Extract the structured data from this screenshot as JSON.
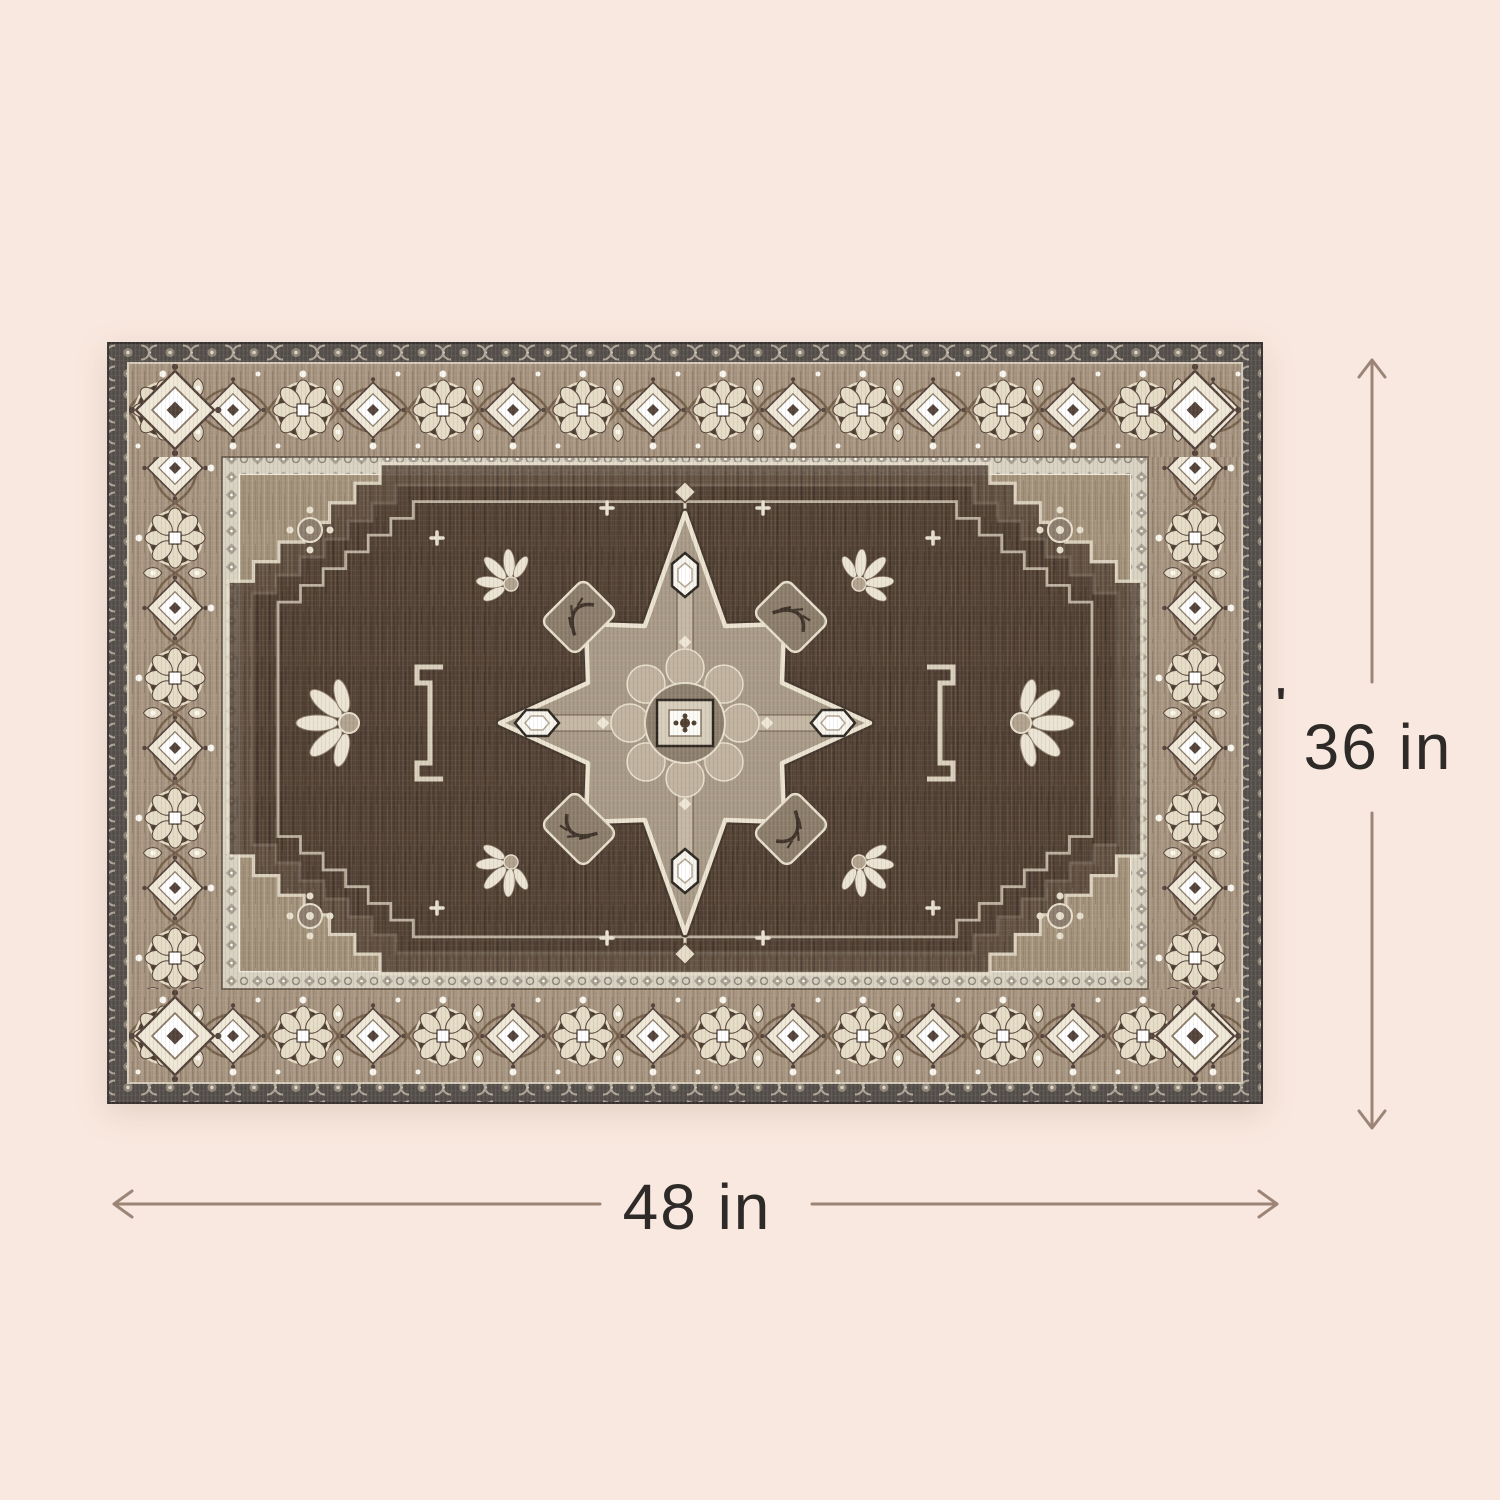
{
  "page": {
    "type": "product-dimension-image",
    "background_color": "#f9e8df"
  },
  "theme": {
    "background": "#f9e8df",
    "arrow": "#9c8577",
    "label": "#2d2a28"
  },
  "product": {
    "name": "Vintage oriental medallion area rug",
    "style": "Persian Heriz medallion with ornate floral borders",
    "colors": {
      "field_dark_brown": "#4e3e33",
      "field_taupe": "#a29179",
      "border_taupe": "#a6917b",
      "ivory_motif": "#e8dfcc",
      "white_accent": "#ffffff",
      "outer_band_charcoal": "#56504d",
      "guard_band_ivory": "#d9d2c2"
    }
  },
  "dimensions": {
    "height_label": "36 in",
    "width_label": "48 in",
    "stray_mark": "'"
  }
}
